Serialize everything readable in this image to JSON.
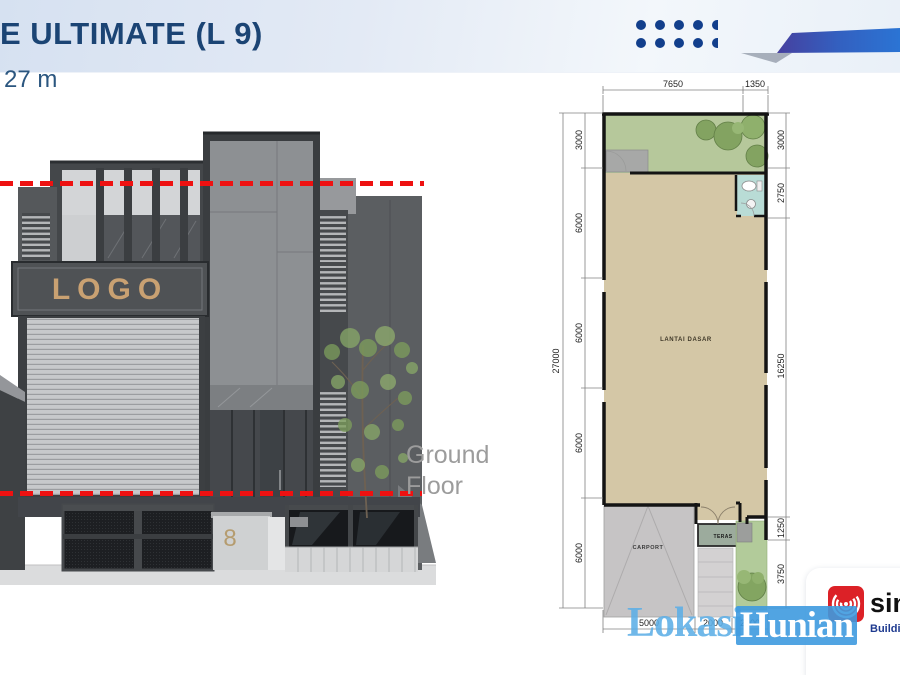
{
  "slide": {
    "title": "E ULTIMATE (L 9)",
    "subtitle": "27 m"
  },
  "elevation": {
    "logo_text": "LOGO",
    "house_number": "8",
    "ground_floor_line1": "Ground",
    "ground_floor_line2": "Floor"
  },
  "floor_plan": {
    "rooms": {
      "main": "LANTAI DASAR",
      "carport": "CARPORT",
      "teras": "TERAS"
    },
    "dimensions": {
      "top": [
        "7650",
        "1350"
      ],
      "left_outer": "27000",
      "left_inner": [
        "3000",
        "6000",
        "6000",
        "6000",
        "6000"
      ],
      "right": [
        "3000",
        "2750",
        "16250",
        "1250",
        "3750"
      ],
      "bottom": [
        "5000",
        "2000",
        "2000"
      ]
    }
  },
  "watermark": {
    "part1": "Lokasi",
    "part2": "Hunian"
  },
  "vendor": {
    "name_visible": "sin",
    "tagline_visible": "Buildin"
  },
  "colors": {
    "title_navy": "#1b4474",
    "dot_blue": "#123f8c",
    "ribbon_indigo": "#46409f",
    "ribbon_blue": "#2b74d4",
    "level_line_red": "#ee1111",
    "ground_floor_gray": "#9c9c9c",
    "plan_garden_green": "#b6c89b",
    "plan_floor_tan": "#d4c7a6",
    "plan_bath_teal": "#b9dcd6",
    "plan_carport_gray": "#c6c4c5",
    "watermark_blue": "#3e9adf",
    "vendor_red": "#dc2127",
    "vendor_tag_blue": "#1e3a8f"
  }
}
